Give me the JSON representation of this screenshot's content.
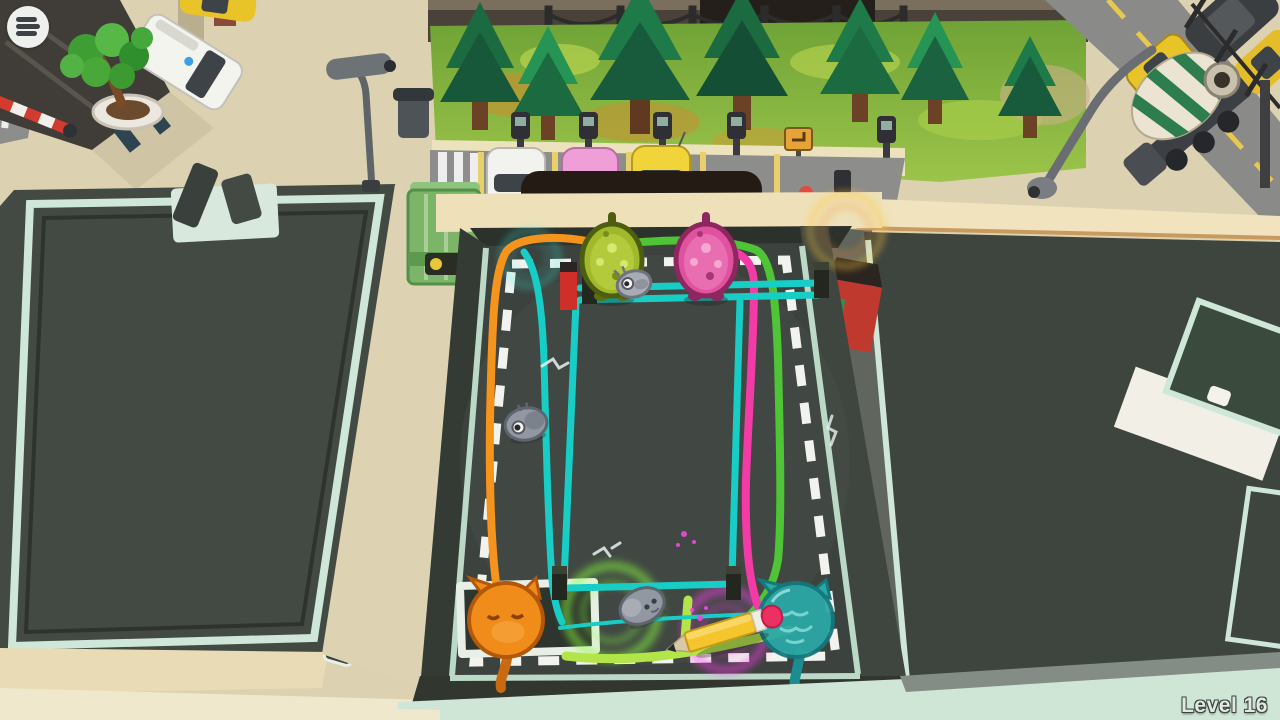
{
  "hud": {
    "menu_button": {
      "icon": "hamburger-menu-icon"
    },
    "level_label": "Level 16"
  },
  "palette": {
    "sidewalk": "#dcd2b2",
    "road": "#8d8d8b",
    "grass": "#84b23e",
    "floor": "#3c423e",
    "trim_mint": "#cfe7d8",
    "roof_dark": "#434a43",
    "level_text": "#e0eae3",
    "path_orange": "#f5941d",
    "path_green": "#4fc436",
    "path_light_green": "#b2e549",
    "path_pink": "#f23ba6",
    "path_teal": "#17cdc6",
    "glow_green": "#8aff3f",
    "glow_magenta": "#ff3df0",
    "glow_teal": "#3df0e6",
    "glow_yellow": "#ffc93d",
    "gummy_green": "#9fb92b",
    "gummy_pink": "#e0519e",
    "bomb_gray": "#9298a2",
    "cat_orange": "#ef8c1a",
    "cat_teal": "#2ba7a6",
    "pencil_yellow": "#f4c52c",
    "pencil_eraser": "#ee2f63"
  },
  "scene": {
    "playfield": {
      "creatures": [
        {
          "id": "green-gummy"
        },
        {
          "id": "pink-gummy"
        },
        {
          "id": "gray-chick"
        },
        {
          "id": "gray-bomb-left"
        },
        {
          "id": "gray-bomb-bottom"
        },
        {
          "id": "orange-cat"
        },
        {
          "id": "teal-cat"
        }
      ],
      "tool": {
        "id": "pencil"
      },
      "drawn_paths": [
        "orange",
        "green",
        "pink",
        "teal-fence",
        "teal-free-line",
        "light-green"
      ]
    },
    "vehicles": [
      "yellow-taxi",
      "white-van",
      "red-car",
      "white-car",
      "pink-car",
      "yellow-car",
      "garbage-truck",
      "cement-mixer-truck",
      "dark-suv",
      "yellow-car-right"
    ]
  }
}
